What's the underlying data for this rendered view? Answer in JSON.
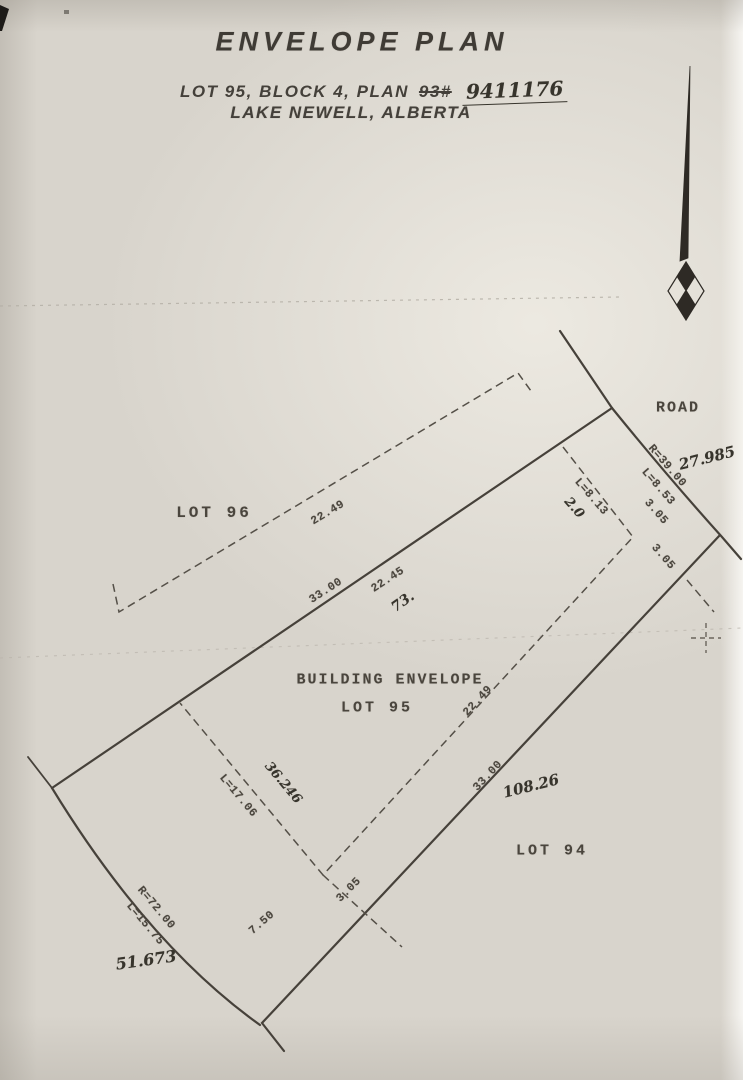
{
  "header": {
    "title": "ENVELOPE PLAN",
    "subtitle_prefix": "LOT 95, BLOCK 4, PLAN",
    "plan_number_struck": "93#",
    "plan_number_handwritten": "9411176",
    "location_line": "LAKE NEWELL, ALBERTA"
  },
  "area_labels": {
    "road": "ROAD",
    "lot96": "LOT 96",
    "building_envelope": "BUILDING ENVELOPE",
    "lot95": "LOT 95",
    "lot94": "LOT 94"
  },
  "typed_dimensions": [
    {
      "text": "22.49"
    },
    {
      "text": "33.00"
    },
    {
      "text": "22.45"
    },
    {
      "text": "R=39.00"
    },
    {
      "text": "L=8.53"
    },
    {
      "text": "3.05"
    },
    {
      "text": "3.05"
    },
    {
      "text": "L=8.13"
    },
    {
      "text": "22.49"
    },
    {
      "text": "33.00"
    },
    {
      "text": "L=17.06"
    },
    {
      "text": "R=72.00"
    },
    {
      "text": "L=15.75"
    },
    {
      "text": "7.50"
    },
    {
      "text": "3.05"
    }
  ],
  "handwritten_annotations": [
    {
      "text": "27.985"
    },
    {
      "text": "2.0"
    },
    {
      "text": "73."
    },
    {
      "text": "108.26"
    },
    {
      "text": "36.246"
    },
    {
      "text": "51.673"
    }
  ],
  "icons": {
    "north_arrow": "north-arrow",
    "survey_cross": "survey-cross-marker"
  },
  "colors": {
    "paper": "#d8d4cc",
    "boundary_line": "#46413a",
    "typed_text": "#4a453d",
    "handwritten_text": "#37342c"
  }
}
